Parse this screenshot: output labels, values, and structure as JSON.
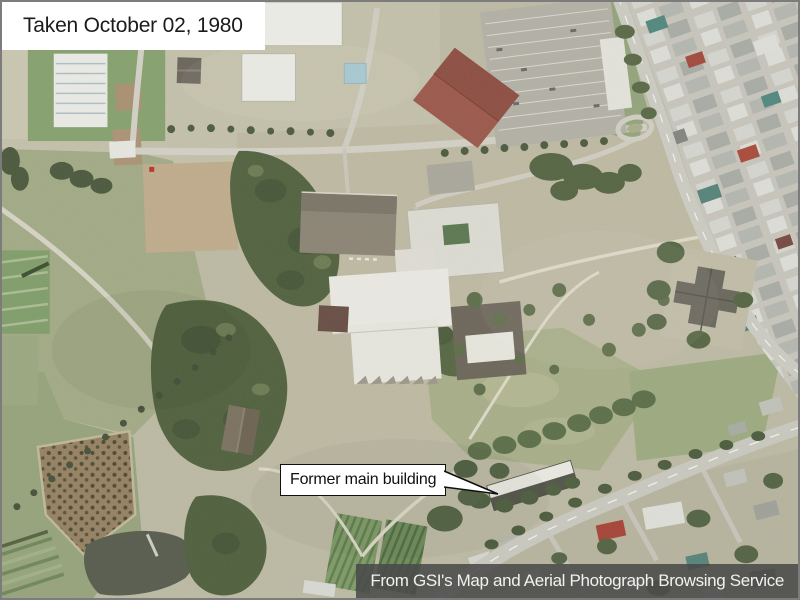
{
  "overlay": {
    "capture_date_label": "Taken October 02, 1980",
    "callout_label": "Former main building",
    "credit_banner": "From GSI's Map and Aerial Photograph Browsing Service"
  },
  "theme": {
    "frame_border": "#7c7c7c",
    "label_bg": "#ffffff",
    "label_text": "#1b1b1b",
    "callout_bg": "#ffffff",
    "callout_border": "#101010",
    "callout_text": "#101010",
    "banner_bg": "rgba(74,74,74,0.88)",
    "banner_text": "#f1f1ef"
  }
}
